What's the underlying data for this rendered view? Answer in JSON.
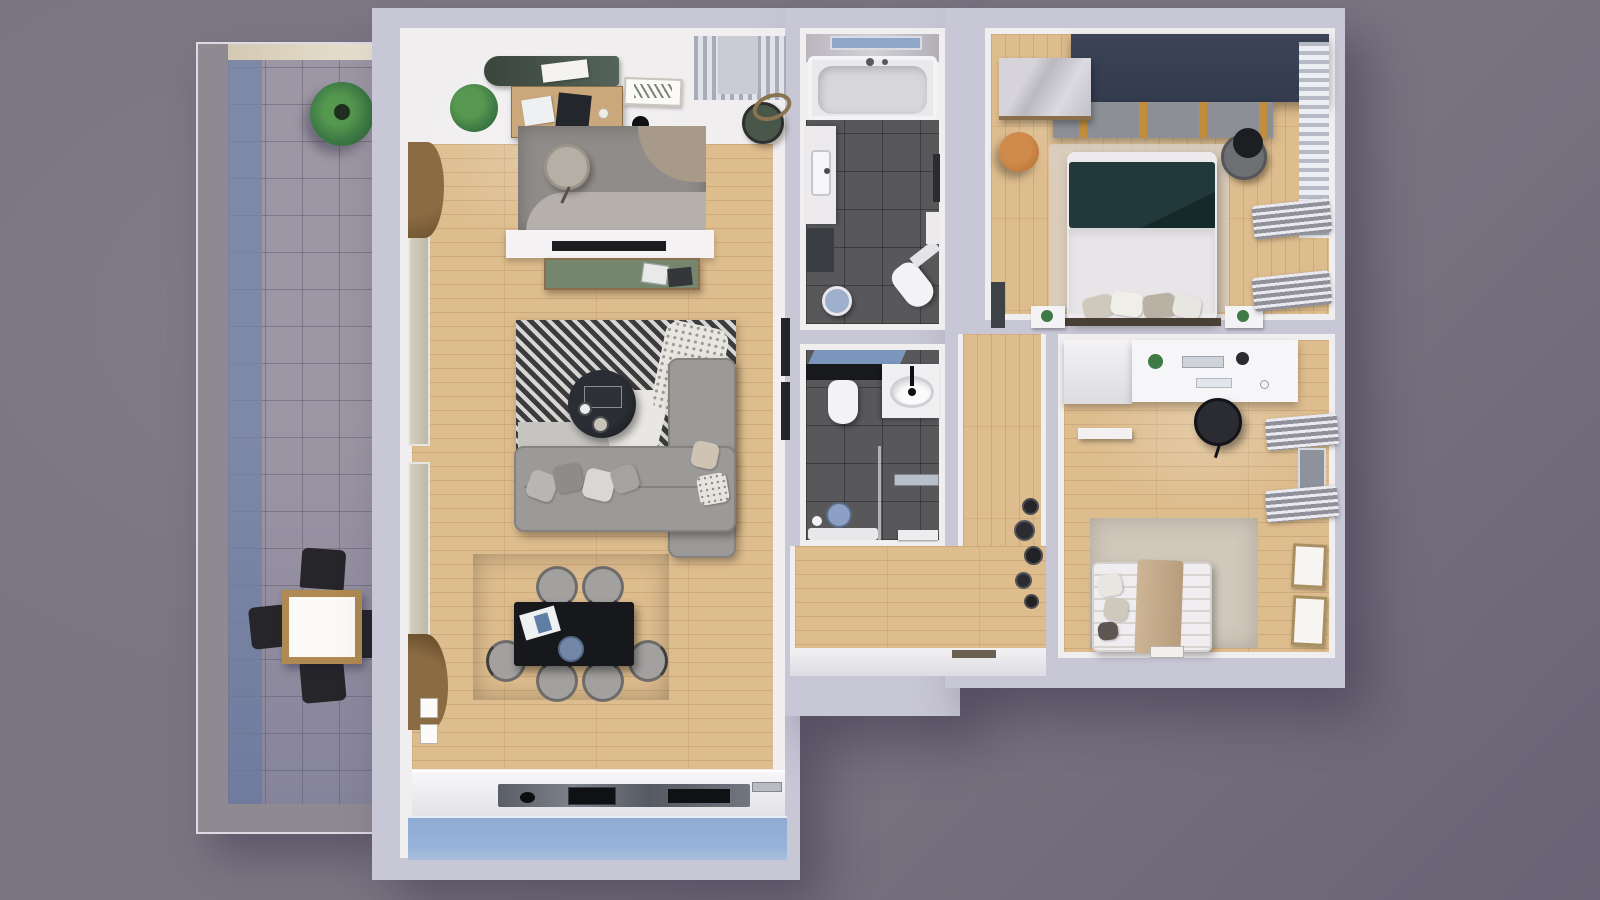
{
  "meta": {
    "title": "3D rendered top-down apartment floor plan",
    "view": "orthographic top-down render",
    "text_visible_on_screen": "none"
  },
  "palette": {
    "backdrop": "#7b7583",
    "backdrop-dark": "#696375",
    "wall": "#c8c7d6",
    "wall-shade": "#a9a7b8",
    "interior-wall": "#f0eeef",
    "wood": "#ddbc8d",
    "tile-dark": "#58585b",
    "balcony-tile": "#9d96a4",
    "balcony-blue": "#7484a8",
    "glass-blue": "#8fa6c8",
    "kitchen-glass": "#97b2d8",
    "sofa-gray": "#9c9a98",
    "navy": "#333c4e",
    "teal-bed": "#21393a",
    "green-console": "#75866f",
    "green-dark": "#3a453c",
    "desk-wood": "#caa87c",
    "black": "#17181c",
    "white": "#f2f1f3",
    "marble": "#ccc9cf",
    "tan": "#bf7a3d",
    "plant-green": "#3d7a45",
    "rug-beige": "#cfc8bb",
    "rug-gray": "#9b9894"
  },
  "rooms": [
    {
      "name": "balcony",
      "floor": "gray tiles with blue edge strip",
      "furniture": [
        "potted-plant",
        "outdoor-dining-table",
        "outdoor-chair-north",
        "outdoor-chair-south",
        "outdoor-chair-west",
        "outdoor-chair-east"
      ]
    },
    {
      "name": "living-room",
      "floor": "light wood planks",
      "zones": [
        "home-office",
        "tv-lounge",
        "dining",
        "kitchen"
      ],
      "furniture": [
        "green-sideboard",
        "office-desk",
        "laptop",
        "open-book",
        "wall-art",
        "desk-lamp",
        "potted-plant",
        "office-rug",
        "office-chair",
        "rattan-armchair",
        "window-curtains",
        "tv-low-wall",
        "tv",
        "green-media-console",
        "magazines",
        "striped-rug",
        "round-coffee-table",
        "corner-sofa",
        "throw-pillows",
        "dotted-throw",
        "dining-rug",
        "dining-table",
        "dining-chairs-x6",
        "blue-vase",
        "kitchen-counter",
        "kitchen-sink",
        "cooktop",
        "counter-appliance",
        "window-band"
      ]
    },
    {
      "name": "bathroom-main",
      "floor": "dark gray tiles",
      "furniture": [
        "bathtub",
        "bath-window",
        "vanity-sink",
        "base-cabinet",
        "round-mirror",
        "toilet",
        "towel-rail",
        "side-cabinet"
      ]
    },
    {
      "name": "bathroom-second",
      "floor": "dark gray tiles",
      "furniture": [
        "black-shelf",
        "toilet",
        "oval-countertop-sink",
        "shower-glass",
        "shower-head",
        "shower-tray",
        "bath-mat",
        "shower-bench"
      ]
    },
    {
      "name": "hallway",
      "floor": "light wood planks",
      "furniture": [
        "wall-plates-decor",
        "entry-threshold",
        "door-mat",
        "dark-door-panels"
      ]
    },
    {
      "name": "bedroom-master",
      "floor": "light wood planks",
      "furniture": [
        "navy-wardrobe",
        "slatted-shelf-band",
        "marble-bench",
        "tan-pouf",
        "double-bed-teal-duvet",
        "pillows",
        "nightstand-left",
        "nightstand-right",
        "armchair-with-clothes",
        "tv-panel",
        "curtains",
        "radiator-x2"
      ]
    },
    {
      "name": "bedroom-second",
      "floor": "light wood planks",
      "furniture": [
        "white-desk",
        "desk-plant",
        "keyboard",
        "office-chair",
        "white-wardrobe",
        "wall-shelf",
        "radiator-x2",
        "beige-rug",
        "single-bed-striped",
        "tan-runner",
        "pillows",
        "picture-frame-x2",
        "open-book"
      ]
    }
  ]
}
